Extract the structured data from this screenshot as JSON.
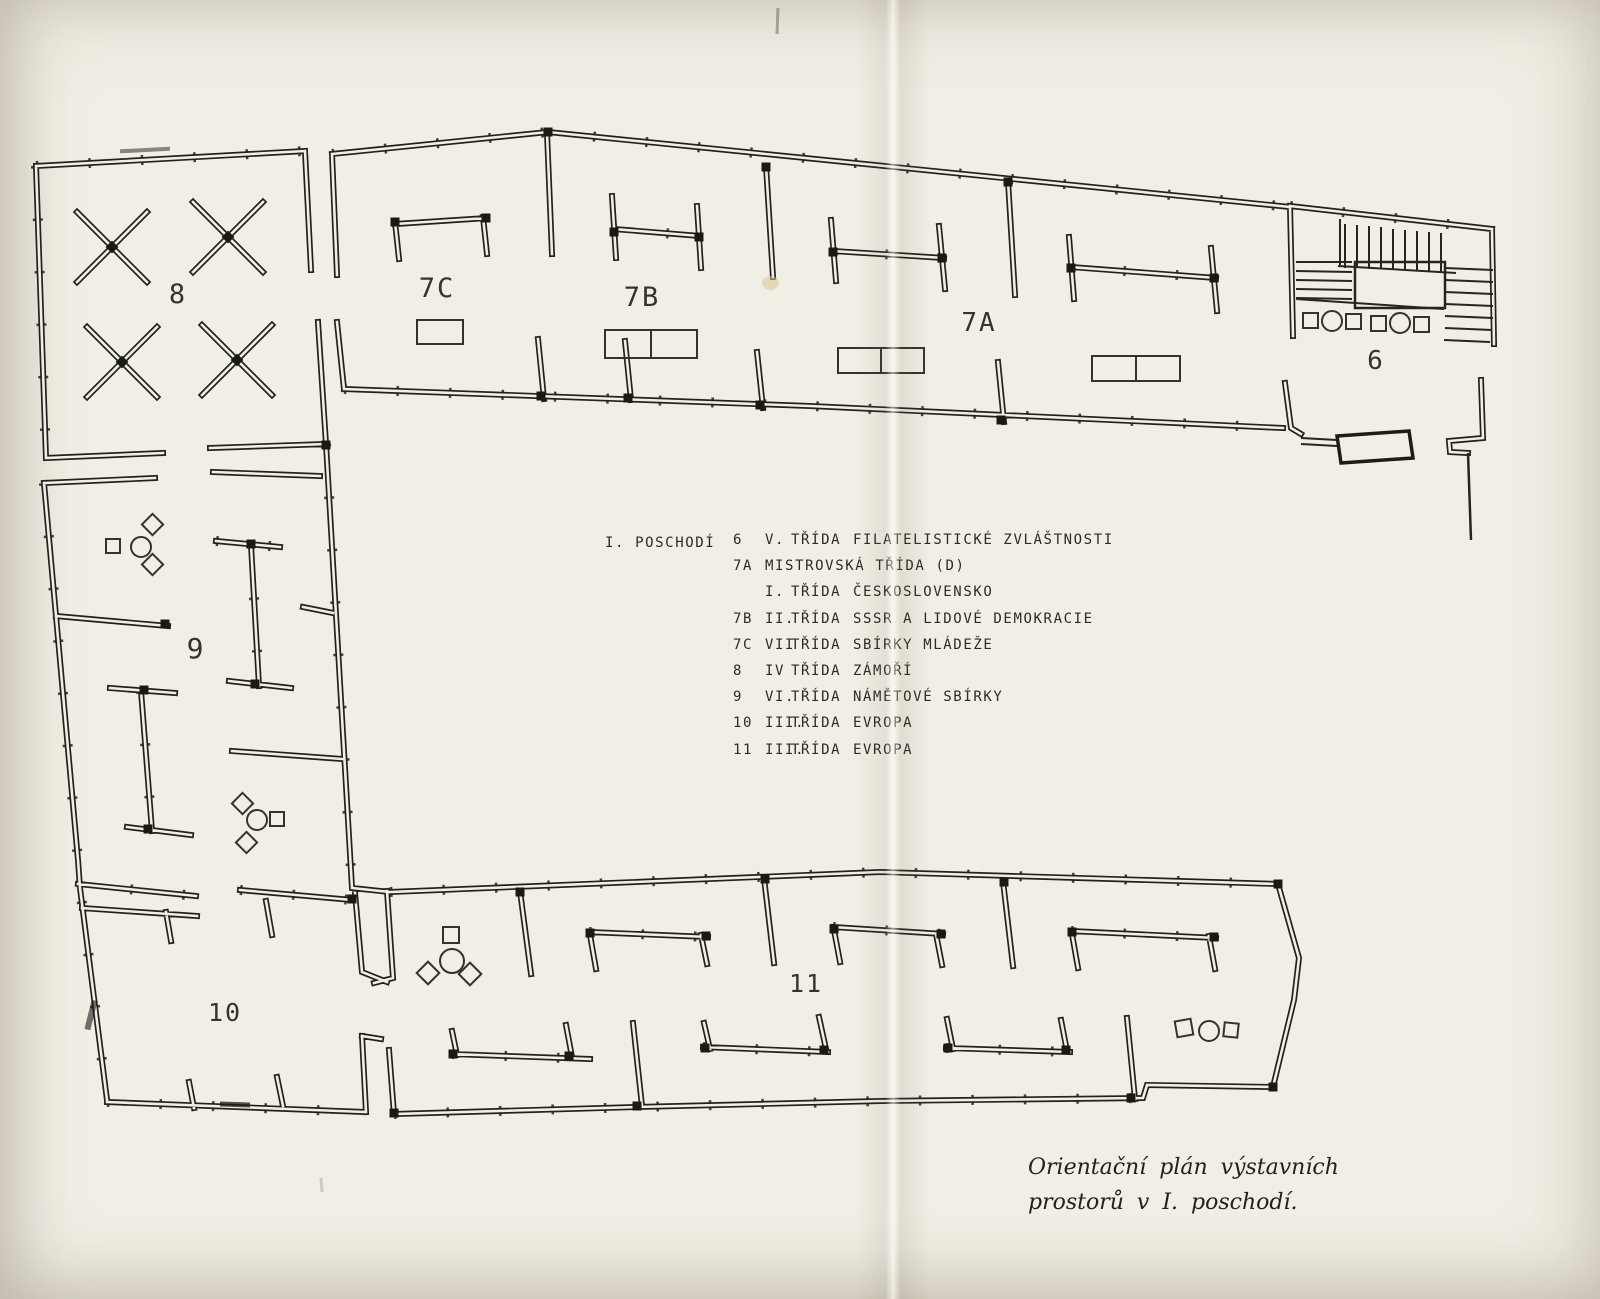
{
  "plan": {
    "floor_heading": "I. POSCHODÍ",
    "room_labels": {
      "r6": "6",
      "r7a": "7A",
      "r7b": "7B",
      "r7c": "7C",
      "r8": "8",
      "r9": "9",
      "r10": "10",
      "r11": "11"
    },
    "legend_rows": [
      {
        "num": "6",
        "roman": "V.",
        "trida": "TŘÍDA",
        "desc": "FILATELISTICKÉ ZVLÁŠTNOSTI"
      },
      {
        "num": "7A",
        "roman": "MISTROVSKÁ TŘÍDA (D)",
        "trida": "",
        "desc": ""
      },
      {
        "num": "",
        "roman": "I.",
        "trida": "TŘÍDA",
        "desc": "ČESKOSLOVENSKO"
      },
      {
        "num": "7B",
        "roman": "II.",
        "trida": "TŘÍDA",
        "desc": "SSSR A LIDOVÉ DEMOKRACIE"
      },
      {
        "num": "7C",
        "roman": "VII",
        "trida": "TŘÍDA",
        "desc": "SBÍRKY MLÁDEŽE"
      },
      {
        "num": "8",
        "roman": "IV",
        "trida": "TŘÍDA",
        "desc": "ZÁMOŘÍ"
      },
      {
        "num": "9",
        "roman": "VI.",
        "trida": "TŘÍDA",
        "desc": "NÁMĚTOVÉ SBÍRKY"
      },
      {
        "num": "10",
        "roman": "III.",
        "trida": "TŘÍDA",
        "desc": "EVROPA"
      },
      {
        "num": "11",
        "roman": "III.",
        "trida": "TŘÍDA",
        "desc": "EVROPA"
      }
    ],
    "caption": {
      "line1": "Orientační plán výstavních",
      "line2": "prostorů v I. poschodí."
    },
    "colors": {
      "paper": "#f1eee5",
      "ink": "#22211d"
    }
  }
}
